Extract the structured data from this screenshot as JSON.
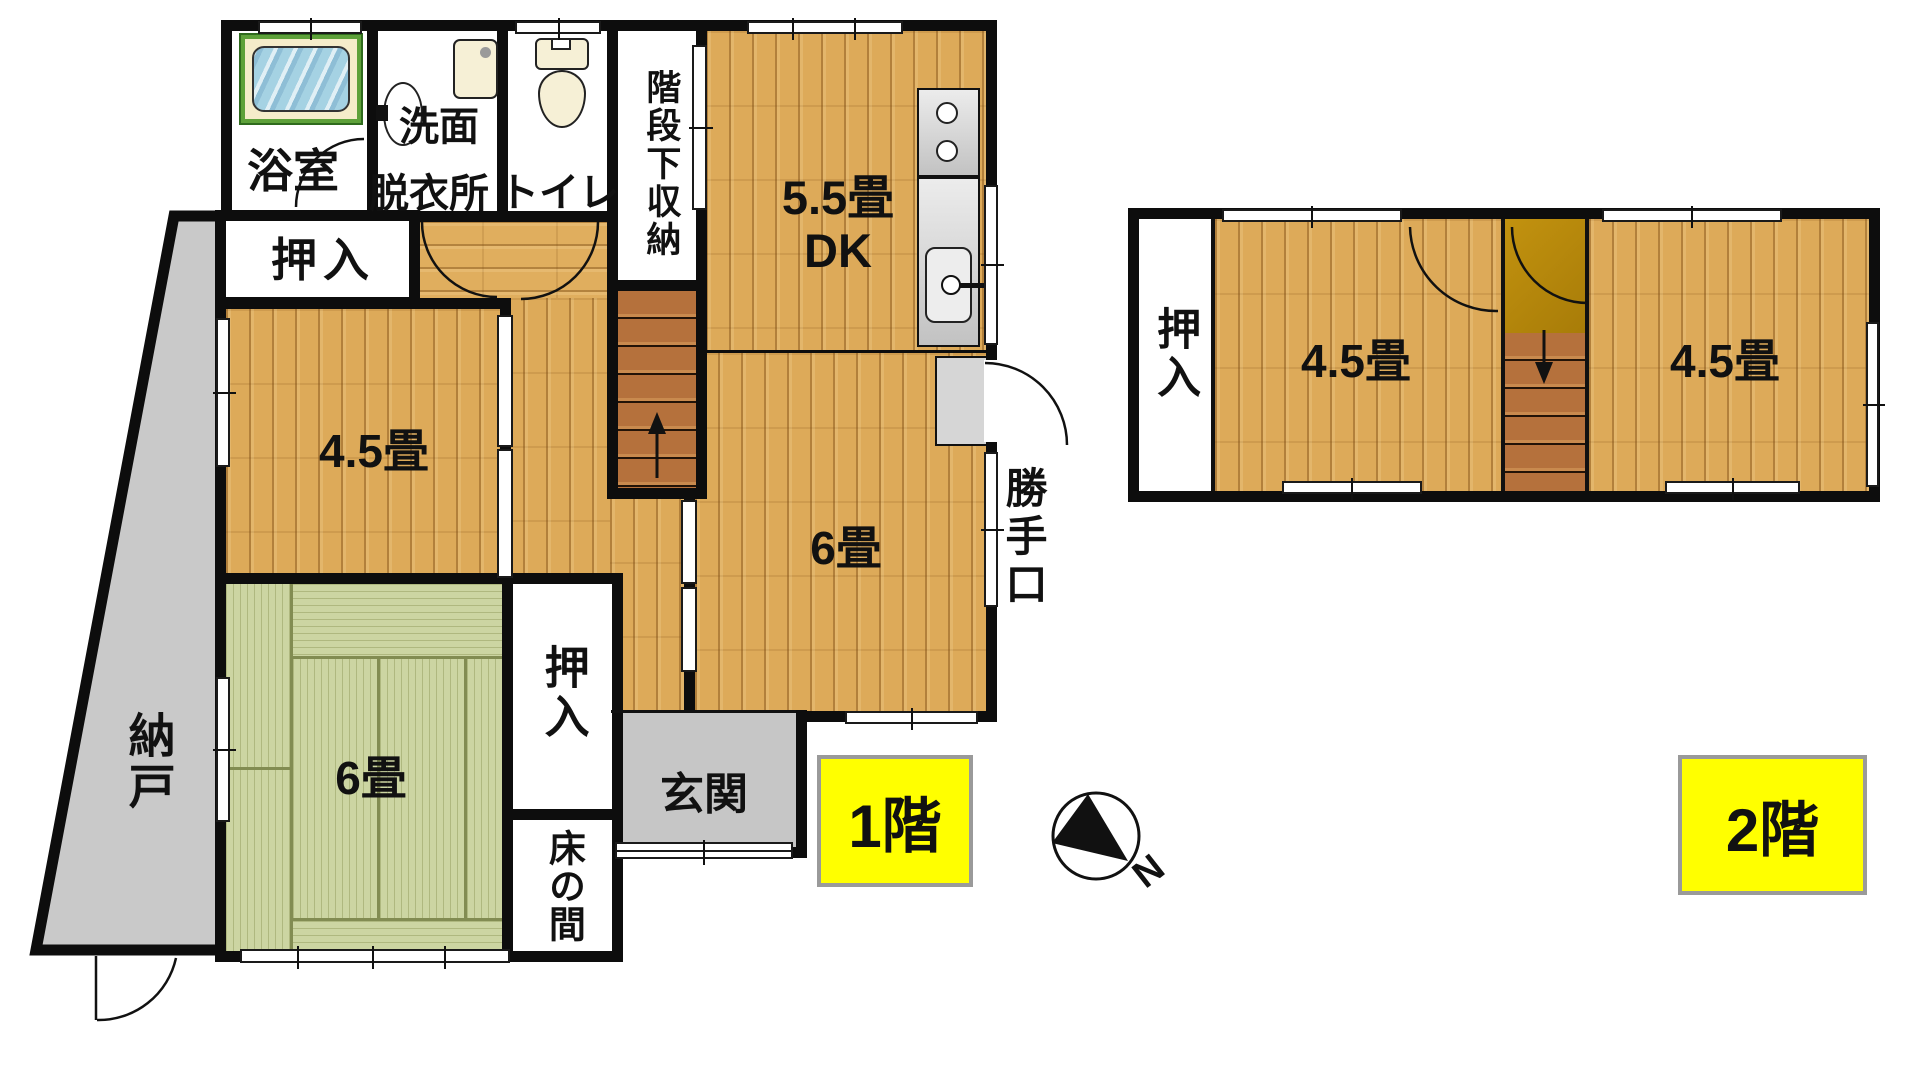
{
  "floor1": {
    "badge": "1階",
    "bath": "浴室",
    "washroom_line1": "洗面",
    "washroom_line2": "脱衣所",
    "toilet": "トイレ",
    "under_stairs_storage": "階段下収納",
    "dk_size": "5.5畳",
    "dk": "DK",
    "closet_top": "押入",
    "room_45": "4.5畳",
    "room_6_wood": "6畳",
    "back_door": "勝手口",
    "tatami_6": "6畳",
    "storage_room": "納戸",
    "closet_bottom": "押入",
    "tokonoma": "床の間",
    "entrance": "玄関"
  },
  "floor2": {
    "badge": "2階",
    "closet": "押入",
    "room_left": "4.5畳",
    "room_right": "4.5畳"
  },
  "compass": {
    "north": "N"
  },
  "colors": {
    "wall": "#0d0d0d",
    "wood_floor": "#ddaa59",
    "tatami": "#ccd5a2",
    "storage_gray": "#c9c9c9",
    "entrance_gray": "#c6c6c6",
    "stair_tread": "#b5713c",
    "stair_landing": "#b8860b",
    "bathtub_frame_green": "#5ea13a",
    "bathtub_surround_cream": "#f5ecca",
    "bathtub_water_blue": "#a5d2e3",
    "badge_yellow": "#ffff00",
    "fixture_cream": "#f6f0d6"
  }
}
